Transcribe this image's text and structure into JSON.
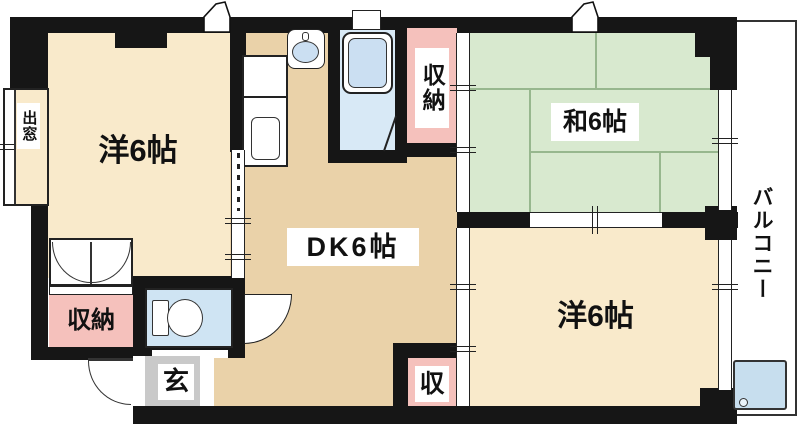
{
  "colors": {
    "wall": "#161616",
    "western_room": "#F9EACB",
    "dk": "#EAD2A9",
    "tatami": "#D8E9CF",
    "tatami_line": "#97B78E",
    "storage": "#F5C1BC",
    "wet": "#CFE4F3",
    "bath_floor": "#D8E9F6",
    "tub": "#CBDFF2",
    "entry": "#C9C9C9",
    "balcony_pan": "#C7DEEE"
  },
  "rooms": {
    "western_top_left": {
      "label": "洋6帖"
    },
    "dining_kitchen": {
      "label": "DK6帖"
    },
    "japanese_room": {
      "label": "和6帖"
    },
    "western_bottom_right": {
      "label": "洋6帖"
    },
    "closet_top": {
      "label": "収納"
    },
    "closet_bottom_left": {
      "label": "収納"
    },
    "closet_bottom_center": {
      "label": "収"
    },
    "entrance": {
      "label": "玄"
    },
    "bay_window": {
      "label": "出窓"
    },
    "balcony": {
      "label": "バルコニー"
    }
  }
}
